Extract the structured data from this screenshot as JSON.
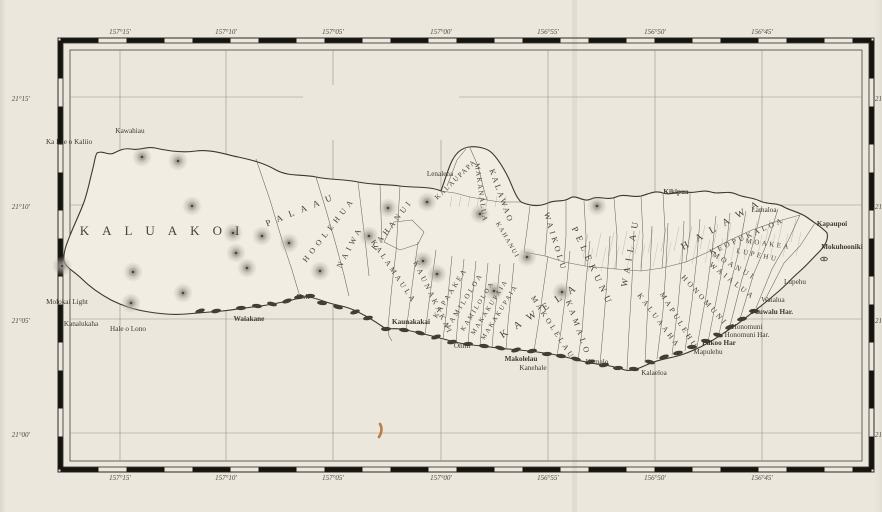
{
  "page": {
    "report_note": "Report U. S. F. C. 1901.  (To face page 476.)",
    "plate": "Plate 27.",
    "caption": "MAP SHOWING LOCATION OF FISH PONDS ON MOLOKAI."
  },
  "title": {
    "word_map": "MAP",
    "word_of": "OF",
    "word_island": "MOLOKAI",
    "subtitle": "Compiled from Hawaiian Government Survey",
    "year": "1897."
  },
  "note": {
    "text": "Note: Fish Ponds shown thus"
  },
  "colors": {
    "paper": "#ebe7dd",
    "island": "#f1ede3",
    "ink": "#3f3c33",
    "line": "#6b6759",
    "pond": "#403e36",
    "stain": "#b96a28"
  },
  "graticule": {
    "lon_labels": [
      {
        "t": "157°15'",
        "x": 120
      },
      {
        "t": "157°10'",
        "x": 226
      },
      {
        "t": "157°05'",
        "x": 333
      },
      {
        "t": "157°00'",
        "x": 441
      },
      {
        "t": "156°55'",
        "x": 548
      },
      {
        "t": "156°50'",
        "x": 655
      },
      {
        "t": "156°45'",
        "x": 762
      }
    ],
    "lat_labels": [
      {
        "t": "21°15'",
        "y": 99
      },
      {
        "t": "21°10'",
        "y": 207
      },
      {
        "t": "21°05'",
        "y": 321
      },
      {
        "t": "21°00'",
        "y": 435
      }
    ],
    "v_lines": [
      {
        "x": 120
      },
      {
        "x": 226
      },
      {
        "x": 333,
        "gap": [
          85,
          140
        ]
      },
      {
        "x": 441,
        "gap": [
          50,
          140
        ]
      },
      {
        "x": 548
      },
      {
        "x": 655
      },
      {
        "x": 762
      }
    ],
    "h_lines": [
      {
        "y": 97,
        "gap": [
          303,
          459
        ]
      },
      {
        "y": 205
      },
      {
        "y": 319
      },
      {
        "y": 433
      }
    ]
  },
  "districts": [
    {
      "t": "KALUAKOI",
      "x": 166,
      "y": 235,
      "r": 0,
      "s": 13,
      "ls": 13
    },
    {
      "t": "PALAAU",
      "x": 303,
      "y": 212,
      "r": -22,
      "s": 9,
      "ls": 7
    },
    {
      "t": "HOOLEHUA",
      "x": 331,
      "y": 231,
      "r": -52,
      "s": 8,
      "ls": 4.5
    },
    {
      "t": "NAIWA",
      "x": 352,
      "y": 248,
      "r": -62,
      "s": 8,
      "ls": 4
    },
    {
      "t": "KAHANUI",
      "x": 394,
      "y": 226,
      "r": -52,
      "s": 8,
      "ls": 3.5
    },
    {
      "t": "KALAMAULA",
      "x": 392,
      "y": 273,
      "r": 56,
      "s": 7.5,
      "ls": 3
    },
    {
      "t": "KAUNAKAKAI",
      "x": 431,
      "y": 299,
      "r": 64,
      "s": 7.5,
      "ls": 3
    },
    {
      "t": "KAPAAKEA",
      "x": 452,
      "y": 294,
      "r": -58,
      "s": 7,
      "ls": 2.5
    },
    {
      "t": "KAMILOLOA",
      "x": 466,
      "y": 302,
      "r": -58,
      "s": 7,
      "ls": 2.5
    },
    {
      "t": "KAMILOLOA",
      "x": 479,
      "y": 307,
      "r": -58,
      "s": 6.5,
      "ls": 2
    },
    {
      "t": "MAKAKUPAIA",
      "x": 491,
      "y": 308,
      "r": -58,
      "s": 6.5,
      "ls": 2
    },
    {
      "t": "MAKAKUPAIA",
      "x": 501,
      "y": 313,
      "r": -58,
      "s": 6.5,
      "ls": 2
    },
    {
      "t": "KAWELA",
      "x": 543,
      "y": 312,
      "r": -33,
      "s": 10,
      "ls": 9
    },
    {
      "t": "MAKOLELAU",
      "x": 551,
      "y": 329,
      "r": 57,
      "s": 7.5,
      "ls": 3
    },
    {
      "t": "KAMALO",
      "x": 576,
      "y": 329,
      "r": 70,
      "s": 8,
      "ls": 4
    },
    {
      "t": "KALUAAHA",
      "x": 657,
      "y": 322,
      "r": 53,
      "s": 7.5,
      "ls": 3
    },
    {
      "t": "MAPULEHU",
      "x": 677,
      "y": 322,
      "r": 58,
      "s": 7.5,
      "ls": 3
    },
    {
      "t": "HONOMUNI",
      "x": 703,
      "y": 302,
      "r": 48,
      "s": 7.5,
      "ls": 3
    },
    {
      "t": "WAIALUA",
      "x": 731,
      "y": 283,
      "r": 38,
      "s": 7.5,
      "ls": 3
    },
    {
      "t": "MOANUI",
      "x": 733,
      "y": 268,
      "r": 30,
      "s": 7.5,
      "ls": 3
    },
    {
      "t": "LUPEHU",
      "x": 757,
      "y": 257,
      "r": 12,
      "s": 7,
      "ls": 2.5
    },
    {
      "t": "MOAKEA",
      "x": 768,
      "y": 246,
      "r": 8,
      "s": 7,
      "ls": 2.5
    },
    {
      "t": "KEOPUKALOA",
      "x": 748,
      "y": 238,
      "r": -24,
      "s": 7.5,
      "ls": 3
    },
    {
      "t": "HALAWA",
      "x": 725,
      "y": 226,
      "r": -30,
      "s": 10,
      "ls": 9
    },
    {
      "t": "WAILAU",
      "x": 633,
      "y": 252,
      "r": -80,
      "s": 9,
      "ls": 6
    },
    {
      "t": "PELEKUNU",
      "x": 590,
      "y": 268,
      "r": 65,
      "s": 9,
      "ls": 5
    },
    {
      "t": "WAIKOLU",
      "x": 553,
      "y": 243,
      "r": 73,
      "s": 8,
      "ls": 3.5
    },
    {
      "t": "KALAWAO",
      "x": 499,
      "y": 197,
      "r": 70,
      "s": 8,
      "ls": 2.5
    },
    {
      "t": "MAKANALUA",
      "x": 479,
      "y": 193,
      "r": 82,
      "s": 7,
      "ls": 1.5
    },
    {
      "t": "KALAUPAPA",
      "x": 457,
      "y": 181,
      "r": -44,
      "s": 7,
      "ls": 1.5
    },
    {
      "t": "KAHANUI",
      "x": 506,
      "y": 241,
      "r": 60,
      "s": 6.5,
      "ls": 1.5
    }
  ],
  "places": [
    {
      "t": "Kawahiau",
      "x": 130,
      "y": 133
    },
    {
      "t": "Ka Lae o Kaliio",
      "x": 69,
      "y": 144
    },
    {
      "t": "Molokai Light",
      "x": 67,
      "y": 304
    },
    {
      "t": "Kanalukaha",
      "x": 81,
      "y": 326
    },
    {
      "t": "Hale o Lono",
      "x": 128,
      "y": 331
    },
    {
      "t": "Waiakane",
      "x": 249,
      "y": 321,
      "b": 1
    },
    {
      "t": "Holi",
      "x": 303,
      "y": 299
    },
    {
      "t": "Kaunakakai",
      "x": 411,
      "y": 324,
      "b": 1
    },
    {
      "t": "Onini",
      "x": 462,
      "y": 348
    },
    {
      "t": "Makolelau",
      "x": 521,
      "y": 361,
      "b": 1
    },
    {
      "t": "Kanehale",
      "x": 533,
      "y": 370
    },
    {
      "t": "Kamalo",
      "x": 597,
      "y": 364
    },
    {
      "t": "Kalaeloa",
      "x": 654,
      "y": 375
    },
    {
      "t": "Lenalena",
      "x": 440,
      "y": 176
    },
    {
      "t": "Kikipua",
      "x": 676,
      "y": 194,
      "b": 1
    },
    {
      "t": "Lamaloa",
      "x": 764,
      "y": 212
    },
    {
      "t": "Kapaupoi",
      "x": 832,
      "y": 226,
      "b": 1
    },
    {
      "t": "Mokuhooniki",
      "x": 842,
      "y": 249,
      "b": 1
    },
    {
      "t": "Lupehu",
      "x": 795,
      "y": 284
    },
    {
      "t": "Waialua",
      "x": 773,
      "y": 302
    },
    {
      "t": "Pauwalu Har.",
      "x": 772,
      "y": 314,
      "b": 1
    },
    {
      "t": "Honomuni",
      "x": 747,
      "y": 329
    },
    {
      "t": "Honomuni Har.",
      "x": 747,
      "y": 337
    },
    {
      "t": "Pukoo Har",
      "x": 719,
      "y": 345,
      "b": 1
    },
    {
      "t": "Mapulehu",
      "x": 708,
      "y": 354
    }
  ],
  "hills": [
    [
      142,
      157
    ],
    [
      178,
      161
    ],
    [
      192,
      206
    ],
    [
      233,
      233
    ],
    [
      262,
      236
    ],
    [
      289,
      243
    ],
    [
      62,
      266
    ],
    [
      133,
      272
    ],
    [
      183,
      293
    ],
    [
      131,
      303
    ],
    [
      236,
      253
    ],
    [
      247,
      268
    ],
    [
      320,
      271
    ],
    [
      369,
      236
    ],
    [
      388,
      208
    ],
    [
      427,
      202
    ],
    [
      480,
      214
    ],
    [
      423,
      261
    ],
    [
      437,
      274
    ],
    [
      494,
      291
    ],
    [
      527,
      257
    ],
    [
      562,
      292
    ],
    [
      597,
      206
    ]
  ],
  "ponds": [
    [
      200,
      311
    ],
    [
      216,
      311
    ],
    [
      241,
      308
    ],
    [
      257,
      306
    ],
    [
      272,
      304
    ],
    [
      287,
      301
    ],
    [
      299,
      297
    ],
    [
      310,
      296
    ],
    [
      322,
      303
    ],
    [
      338,
      307
    ],
    [
      355,
      312
    ],
    [
      368,
      318
    ],
    [
      386,
      329
    ],
    [
      404,
      330
    ],
    [
      420,
      333
    ],
    [
      436,
      337
    ],
    [
      452,
      342
    ],
    [
      468,
      344
    ],
    [
      484,
      346
    ],
    [
      500,
      348
    ],
    [
      516,
      350
    ],
    [
      532,
      351
    ],
    [
      547,
      354
    ],
    [
      561,
      356
    ],
    [
      576,
      359
    ],
    [
      590,
      362
    ],
    [
      604,
      365
    ],
    [
      618,
      368
    ],
    [
      634,
      369
    ],
    [
      650,
      362
    ],
    [
      664,
      357
    ],
    [
      678,
      353
    ],
    [
      692,
      347
    ],
    [
      706,
      341
    ],
    [
      718,
      335
    ],
    [
      730,
      327
    ],
    [
      742,
      319
    ],
    [
      754,
      311
    ]
  ],
  "islet": {
    "x": 824,
    "y": 259
  },
  "stain": {
    "x": 380,
    "y": 424
  },
  "shapes": {
    "island": "M 97,153 C 103,150 108,156 114,153 C 120,150 124,148 131,149 C 139,151 146,146 155,148 C 168,151 182,153 196,151 C 210,149 224,154 238,157 C 252,160 264,163 276,170 C 289,177 303,174 316,177 C 330,180 344,179 358,182 C 372,185 386,184 400,186 C 414,188 430,186 441,191 C 444,183 447,172 451,163 C 455,154 461,148 469,147 C 477,146 487,148 492,153 C 497,158 503,167 508,177 C 512,185 515,196 521,202 C 530,206 539,207 548,203 C 556,199 562,203 570,198 C 577,194 583,203 591,199 C 599,195 607,201 616,197 C 624,193 632,198 641,196 C 649,194 655,190 663,193 C 671,196 678,190 687,192 C 695,194 702,189 711,192 C 719,195 727,190 736,194 C 744,198 752,197 760,201 C 768,205 776,202 784,207 C 791,211 800,212 808,218 C 816,224 823,228 827,233 C 829,240 824,247 818,253 C 812,259 806,266 799,272 C 792,278 786,285 779,291 C 772,297 765,303 757,309 C 749,315 741,322 733,327 C 725,332 717,338 708,343 C 699,348 690,352 681,355 C 671,358 661,359 651,363 C 641,367 633,372 625,370 C 619,368 612,366 604,365 C 595,364 586,362 577,360 C 566,357 555,354 544,353 C 532,351 520,350 508,349 C 496,348 484,346 472,345 C 460,344 448,340 436,337 C 424,334 412,331 401,329 C 394,328 388,330 383,327 C 376,322 368,317 360,313 C 351,308 342,306 333,304 C 324,302 315,297 307,297 C 299,297 291,301 283,302 C 273,304 263,306 253,307 C 243,308 233,310 222,311 C 210,312 198,313 186,314 C 174,315 161,314 149,312 C 136,310 123,306 111,300 C 100,294 90,287 82,279 C 74,271 66,268 64,261 C 63,252 67,243 71,233 C 75,223 80,213 84,202 C 88,191 90,179 93,168 C 95,160 95,156 97,153 Z",
    "boundaries": [
      "256,159 270,200 282,240 292,270 300,297",
      "316,177 326,210 336,245 344,275 349,296",
      "358,182 362,215 366,248 369,276",
      "380,185 381,215 382,243",
      "400,186 398,220 396,252 392,285 388,327",
      "384,242 400,250 418,244 424,232 412,220 394,222 384,242",
      "418,242 414,272 410,302 406,331",
      "436,250 432,280 428,310 425,335",
      "452,256 449,286 446,316 443,339",
      "464,259 461,289 458,319 456,343",
      "476,261 473,291 470,321 468,344",
      "488,263 485,293 482,323 480,346",
      "500,264 497,294 494,324 492,347",
      "514,263 511,293 508,323 506,349",
      "548,256 543,291 538,326 534,351",
      "570,251 566,291 561,331 557,356",
      "590,241 586,281 582,331 578,360",
      "610,236 607,281 603,331 600,364",
      "634,231 632,281 629,331 627,370",
      "652,226 650,271 647,321 645,363",
      "668,223 666,266 663,311 657,359",
      "684,221 682,261 678,306 672,355",
      "700,219 697,256 692,301 685,351",
      "716,216 712,251 706,296 697,347",
      "730,213 726,249 718,291 708,342",
      "746,211 740,246 730,286 719,334",
      "762,206 754,241 742,279 730,326",
      "778,209 768,241 754,273 740,319",
      "800,215 788,241 772,269 756,308",
      "815,223 800,246 784,263 766,298",
      "530,206 527,230 524,252",
      "548,204 547,232 545,256",
      "566,200 566,236 564,262",
      "584,201 586,236 585,266",
      "614,198 617,236 616,269",
      "641,196 643,236 641,271",
      "663,193 665,231 662,268",
      "690,192 690,231 686,262",
      "524,252 545,256 564,262 585,266 616,269 641,271 662,268 686,262 708,252 730,240 752,230 775,222 800,215",
      "447,186 457,160 466,149",
      "470,148 478,166 484,190 487,200",
      "441,191 455,193 470,197 487,200 500,202 521,202",
      "388,327 389,336 392,341"
    ]
  }
}
